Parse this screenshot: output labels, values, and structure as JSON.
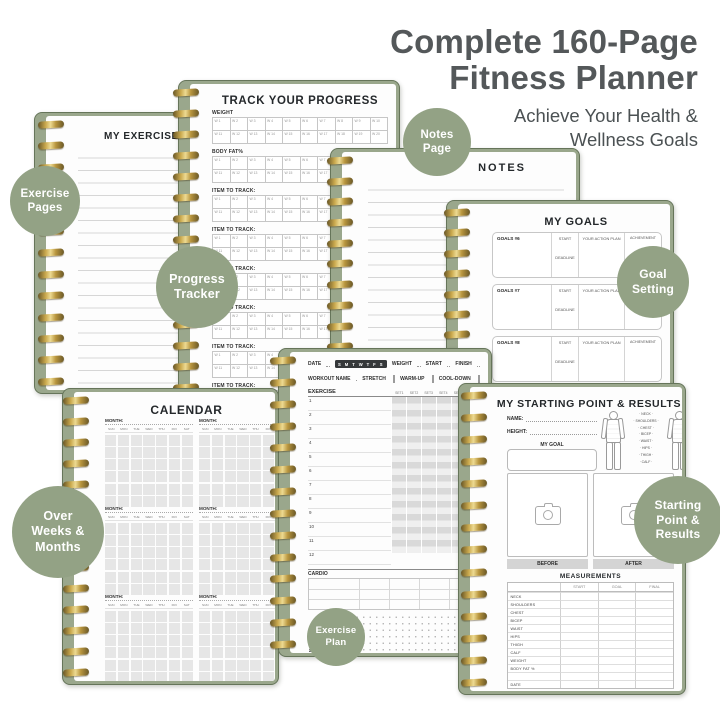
{
  "header": {
    "title_line1": "Complete 160-Page",
    "title_line2": "Fitness Planner",
    "subtitle_line1": "Achieve Your Health &",
    "subtitle_line2": "Wellness Goals"
  },
  "colors": {
    "badge_green": "#93a285",
    "cover_green": "#9aa78c",
    "spiral_gold": "#caa94e",
    "heading_gray": "#54585a"
  },
  "badges": {
    "exercise_pages": "Exercise\nPages",
    "progress_tracker": "Progress\nTracker",
    "notes_page": "Notes\nPage",
    "goal_setting": "Goal\nSetting",
    "over_weeks_months": "Over\nWeeks &\nMonths",
    "starting_point_results": "Starting\nPoint &\nResults",
    "exercise_plan": "Exercise\nPlan"
  },
  "pages": {
    "exercises": {
      "title": "MY EXERCISES"
    },
    "track": {
      "title": "TRACK YOUR PROGRESS",
      "sections": [
        "WEIGHT",
        "BODY FAT%",
        "ITEM TO TRACK:",
        "ITEM TO TRACK:",
        "ITEM TO TRACK:",
        "ITEM TO TRACK:",
        "ITEM TO TRACK:",
        "ITEM TO TRACK:"
      ],
      "weeks": [
        "W 1",
        "W 2",
        "W 3",
        "W 4",
        "W 5",
        "W 6",
        "W 7",
        "W 8",
        "W 9",
        "W 10",
        "W 11",
        "W 12",
        "W 13",
        "W 14",
        "W 15",
        "W 16",
        "W 17",
        "W 18",
        "W 19",
        "W 20"
      ]
    },
    "notes": {
      "title": "NOTES"
    },
    "goals": {
      "title": "MY GOALS",
      "start_label": "START",
      "deadline_label": "DEADLINE",
      "action_label": "YOUR ACTION PLAN",
      "achievement_label": "ACHIEVEMENT",
      "rows": [
        "GOALS #6",
        "GOALS #7",
        "GOALS #8",
        "GOALS #9"
      ]
    },
    "calendar": {
      "title": "CALENDAR",
      "month_label": "MONTH:",
      "days": [
        "SUN",
        "MON",
        "TUE",
        "WED",
        "THU",
        "FRI",
        "SAT"
      ]
    },
    "workout": {
      "date_label": "DATE",
      "days_chip": "S M T W T F S",
      "weight_label": "WEIGHT",
      "start_label": "START",
      "finish_label": "FINISH",
      "workout_name_label": "WORKOUT NAME",
      "stretch_label": "STRETCH",
      "warmup_label": "WARM-UP",
      "cooldown_label": "COOL-DOWN",
      "exercise_label": "EXERCISE",
      "set_headers": [
        "SET1",
        "SET2",
        "SET3",
        "SET4",
        "SET5",
        "SET6"
      ],
      "row_numbers": [
        "1",
        "2",
        "3",
        "4",
        "5",
        "6",
        "7",
        "8",
        "9",
        "10",
        "11",
        "12"
      ],
      "cardio_label": "CARDIO",
      "cardio_headers": [
        "TIME",
        "DISTANCE",
        "INTENSITY",
        "CALORIES"
      ],
      "notes_label": "NOTES",
      "rate_label": "RATE",
      "bodyfat_label": "BODY FAT %",
      "weight2_label": "WEIGHT"
    },
    "starting": {
      "title": "MY STARTING POINT & RESULTS",
      "name_label": "NAME:",
      "height_label": "HEIGHT:",
      "goal_label": "MY GOAL",
      "body_labels": [
        "NECK",
        "SHOULDERS",
        "CHEST",
        "BICEP",
        "WAIST",
        "HIPS",
        "THIGH",
        "CALF"
      ],
      "before_label": "BEFORE",
      "after_label": "AFTER",
      "measurements_title": "MEASUREMENTS",
      "measure_headers": [
        "START",
        "GOAL",
        "FINAL"
      ],
      "measure_rows": [
        "NECK",
        "SHOULDERS",
        "CHEST",
        "BICEP",
        "WAIST",
        "HIPS",
        "THIGH",
        "CALF",
        "WEIGHT",
        "BODY FAT %",
        "",
        "DATE"
      ]
    }
  }
}
